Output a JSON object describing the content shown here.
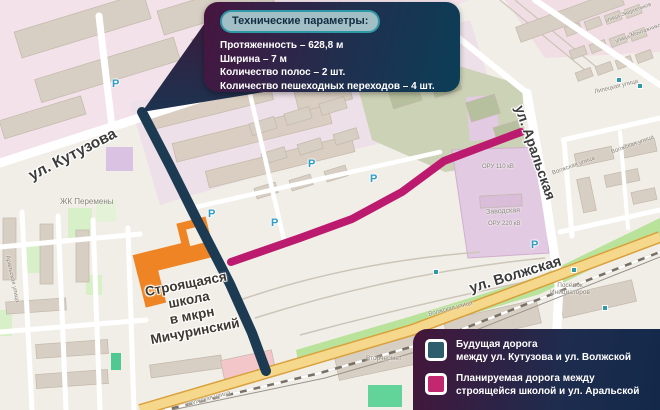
{
  "callout": {
    "title": "Технические параметры:",
    "lines": [
      "Протяженность – 628,8 м",
      "Ширина – 7 м",
      "Количество полос – 2 шт.",
      "Количество пешеходных переходов – 4 шт."
    ]
  },
  "legend": {
    "items": [
      {
        "swatch_color": "#2e5d6e",
        "line1": "Будущая дорога",
        "line2": "между ул. Кутузова и ул. Волжской"
      },
      {
        "swatch_color": "#c2286f",
        "line1": "Планируемая дорога между",
        "line2": "строящейся школой и ул. Аральской"
      }
    ]
  },
  "map": {
    "streets": {
      "kutuzova": "ул. Кутузова",
      "aralskaya": "ул. Аральская",
      "volzhskaya": "ул. Волжская"
    },
    "school": {
      "line1": "Строящаяся",
      "line2": "школа",
      "line3": "в мкрн",
      "line4": "Мичуринский"
    },
    "minor_labels": {
      "zhk_peremeny": "ЖК Перемены",
      "oru110": "ОРУ 110 кВ",
      "zavodskaya": "Заводская",
      "oru220": "ОРУ 220 кВ",
      "volzhskaya_ulitsa": "Волжская улица",
      "poselok1": "Посёлок",
      "poselok2": "Инициаторов",
      "vtorchermet": "Вторчермет",
      "aralskaya_ulitsa": "Аральская улица",
      "energetikov": "улица Энергетиков",
      "montazhnikov": "улица Монтажников",
      "lipetskaya": "Липецкая улица"
    },
    "parking_label": "P"
  },
  "highlight_colors": {
    "future_road": "#1d3a53",
    "planned_road": "#bb1a6e"
  }
}
